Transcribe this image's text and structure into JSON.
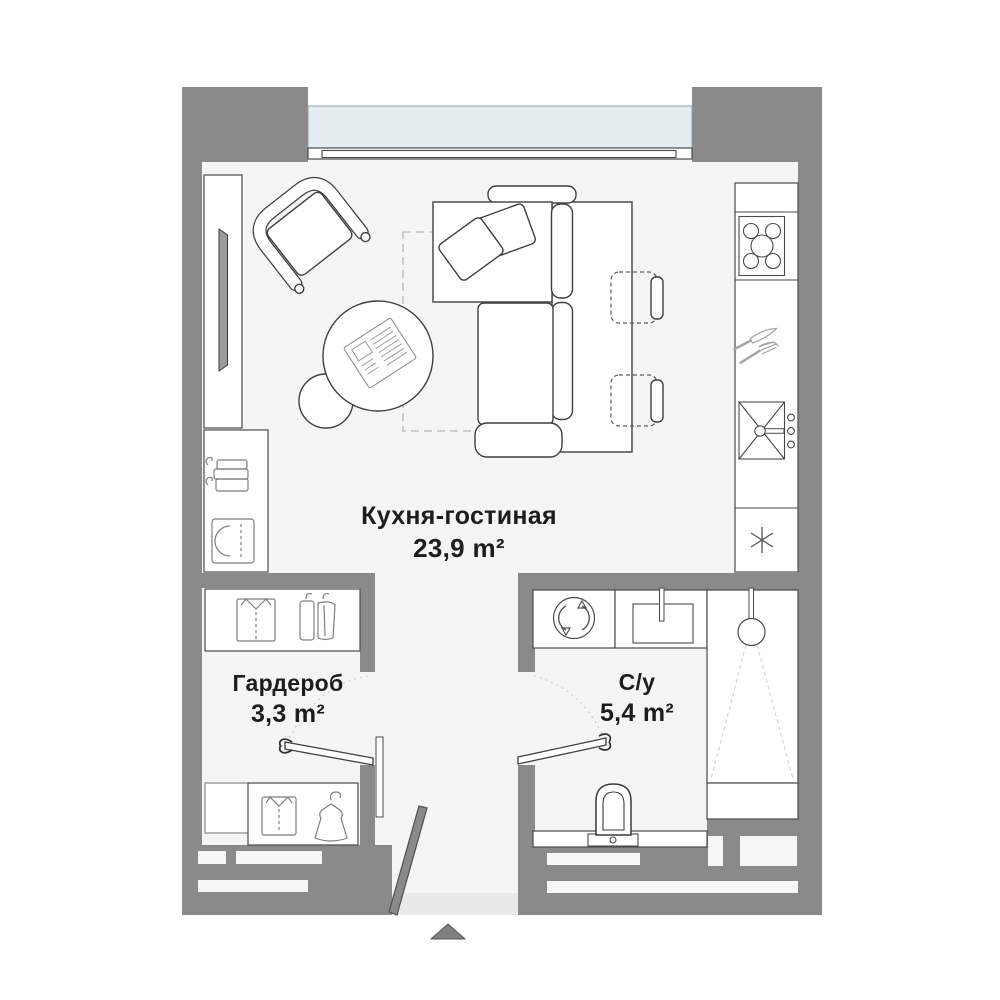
{
  "title": "Floor plan — studio apartment",
  "rooms": [
    {
      "id": "kitchen-living",
      "name": "Кухня-гостиная",
      "area": "23,9 m²"
    },
    {
      "id": "wardrobe",
      "name": "Гардероб",
      "area": "3,3 m²"
    },
    {
      "id": "bathroom",
      "name": "С/у",
      "area": "5,4 m²"
    }
  ],
  "colors": {
    "wall": "#8a8a8a",
    "floor": "#f5f5f5",
    "glass": "#e3edf2",
    "threshold": "#e9e9e9",
    "text": "#1d1d1d",
    "outline": "#3f3f3f"
  },
  "icons": [
    "window",
    "tv-icon",
    "armchair",
    "sofa",
    "pillow-icon",
    "coffee-table",
    "newspaper-icon",
    "pouf",
    "rug",
    "dining-table",
    "dining-chair",
    "stove-icon",
    "cutlery-icon",
    "kitchen-sink-icon",
    "fridge-asterisk-icon",
    "folded-clothes-icon",
    "shirt-icon",
    "hanging-clothes-icon",
    "dress-icon",
    "washing-machine-icon",
    "bathroom-sink-icon",
    "shower-icon",
    "toilet-icon",
    "door-swing",
    "entrance-arrow-icon"
  ]
}
